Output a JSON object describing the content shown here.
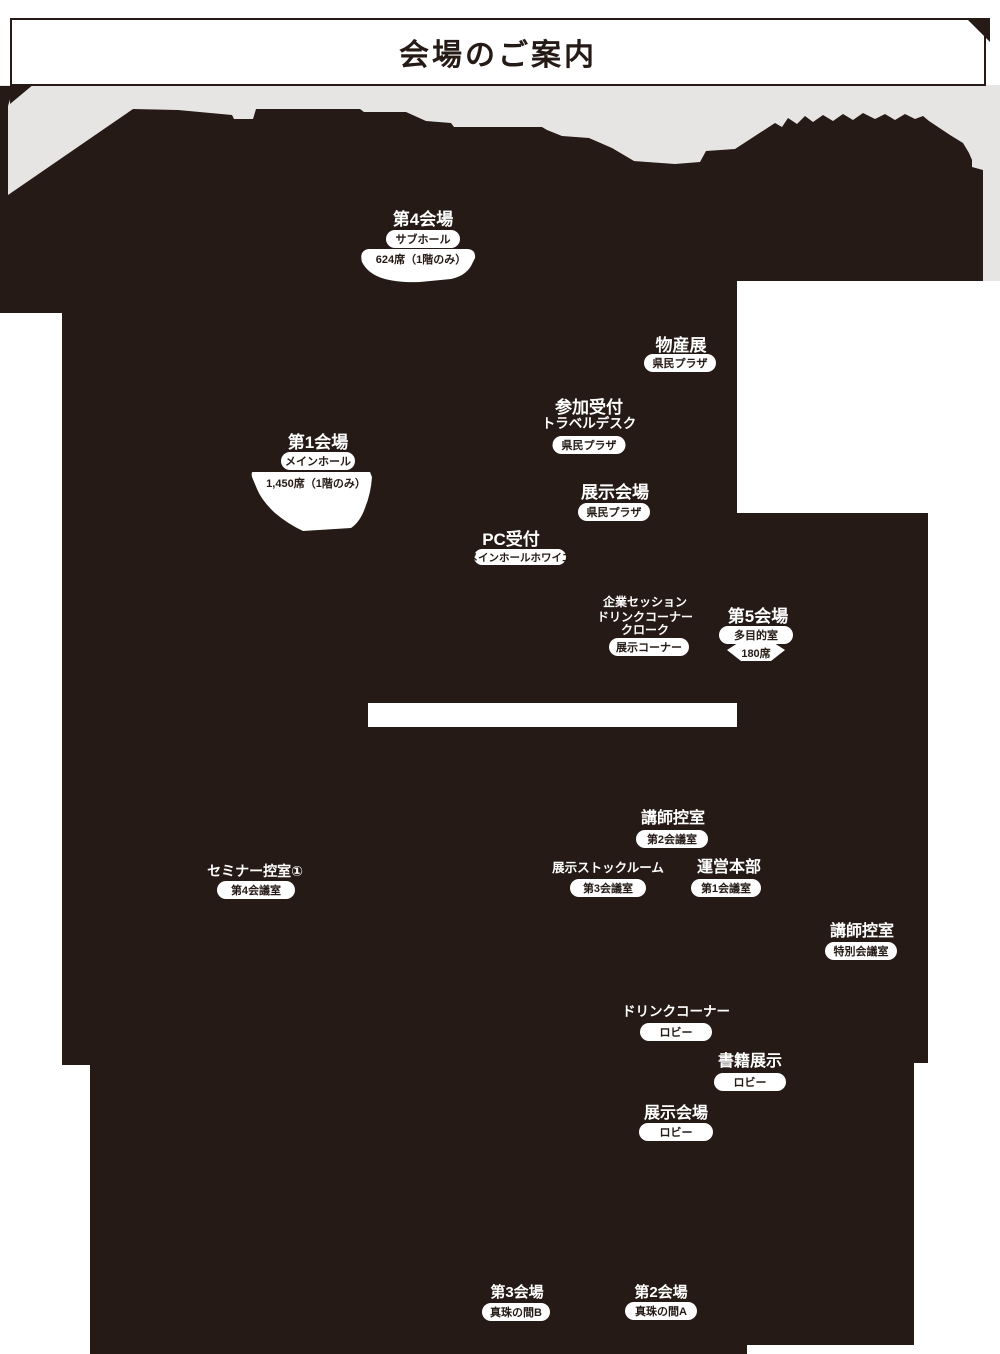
{
  "title": "会場のご案内",
  "colors": {
    "dark": "#251a15",
    "gray": "#e7e5e3",
    "white": "#ffffff"
  },
  "map": {
    "halls": {
      "hall4": {
        "name": "第4会場",
        "room": "サブホール",
        "capacity": "624席（1階のみ）"
      },
      "hall1": {
        "name": "第1会場",
        "room": "メインホール",
        "capacity": "1,450席（1階のみ）"
      },
      "hall5": {
        "name": "第5会場",
        "room": "多目的室",
        "capacity": "180席"
      },
      "hall3": {
        "name": "第3会場",
        "room": "真珠の間B"
      },
      "hall2": {
        "name": "第2会場",
        "room": "真珠の間A"
      }
    },
    "areas": {
      "bussanten": {
        "name": "物産展",
        "room": "県民プラザ"
      },
      "reception": {
        "name": "参加受付",
        "sub": "トラベルデスク",
        "room": "県民プラザ"
      },
      "exhibition_plaza": {
        "name": "展示会場",
        "room": "県民プラザ"
      },
      "pc_reception": {
        "name": "PC受付",
        "room": "メインホールホワイエ"
      },
      "corporate": {
        "lines": [
          "企業セッション",
          "ドリンクコーナー",
          "クローク"
        ],
        "room": "展示コーナー"
      },
      "lecturer_room2": {
        "name": "講師控室",
        "room": "第2会議室"
      },
      "seminar_waiting": {
        "name": "セミナー控室①",
        "room": "第4会議室"
      },
      "stock_room": {
        "name": "展示ストックルーム",
        "room": "第3会議室"
      },
      "hq": {
        "name": "運営本部",
        "room": "第1会議室"
      },
      "lecturer_special": {
        "name": "講師控室",
        "room": "特別会議室"
      },
      "drink_lobby": {
        "name": "ドリンクコーナー",
        "room": "ロビー"
      },
      "books": {
        "name": "書籍展示",
        "room": "ロビー"
      },
      "exhibition_lobby": {
        "name": "展示会場",
        "room": "ロビー"
      }
    }
  }
}
